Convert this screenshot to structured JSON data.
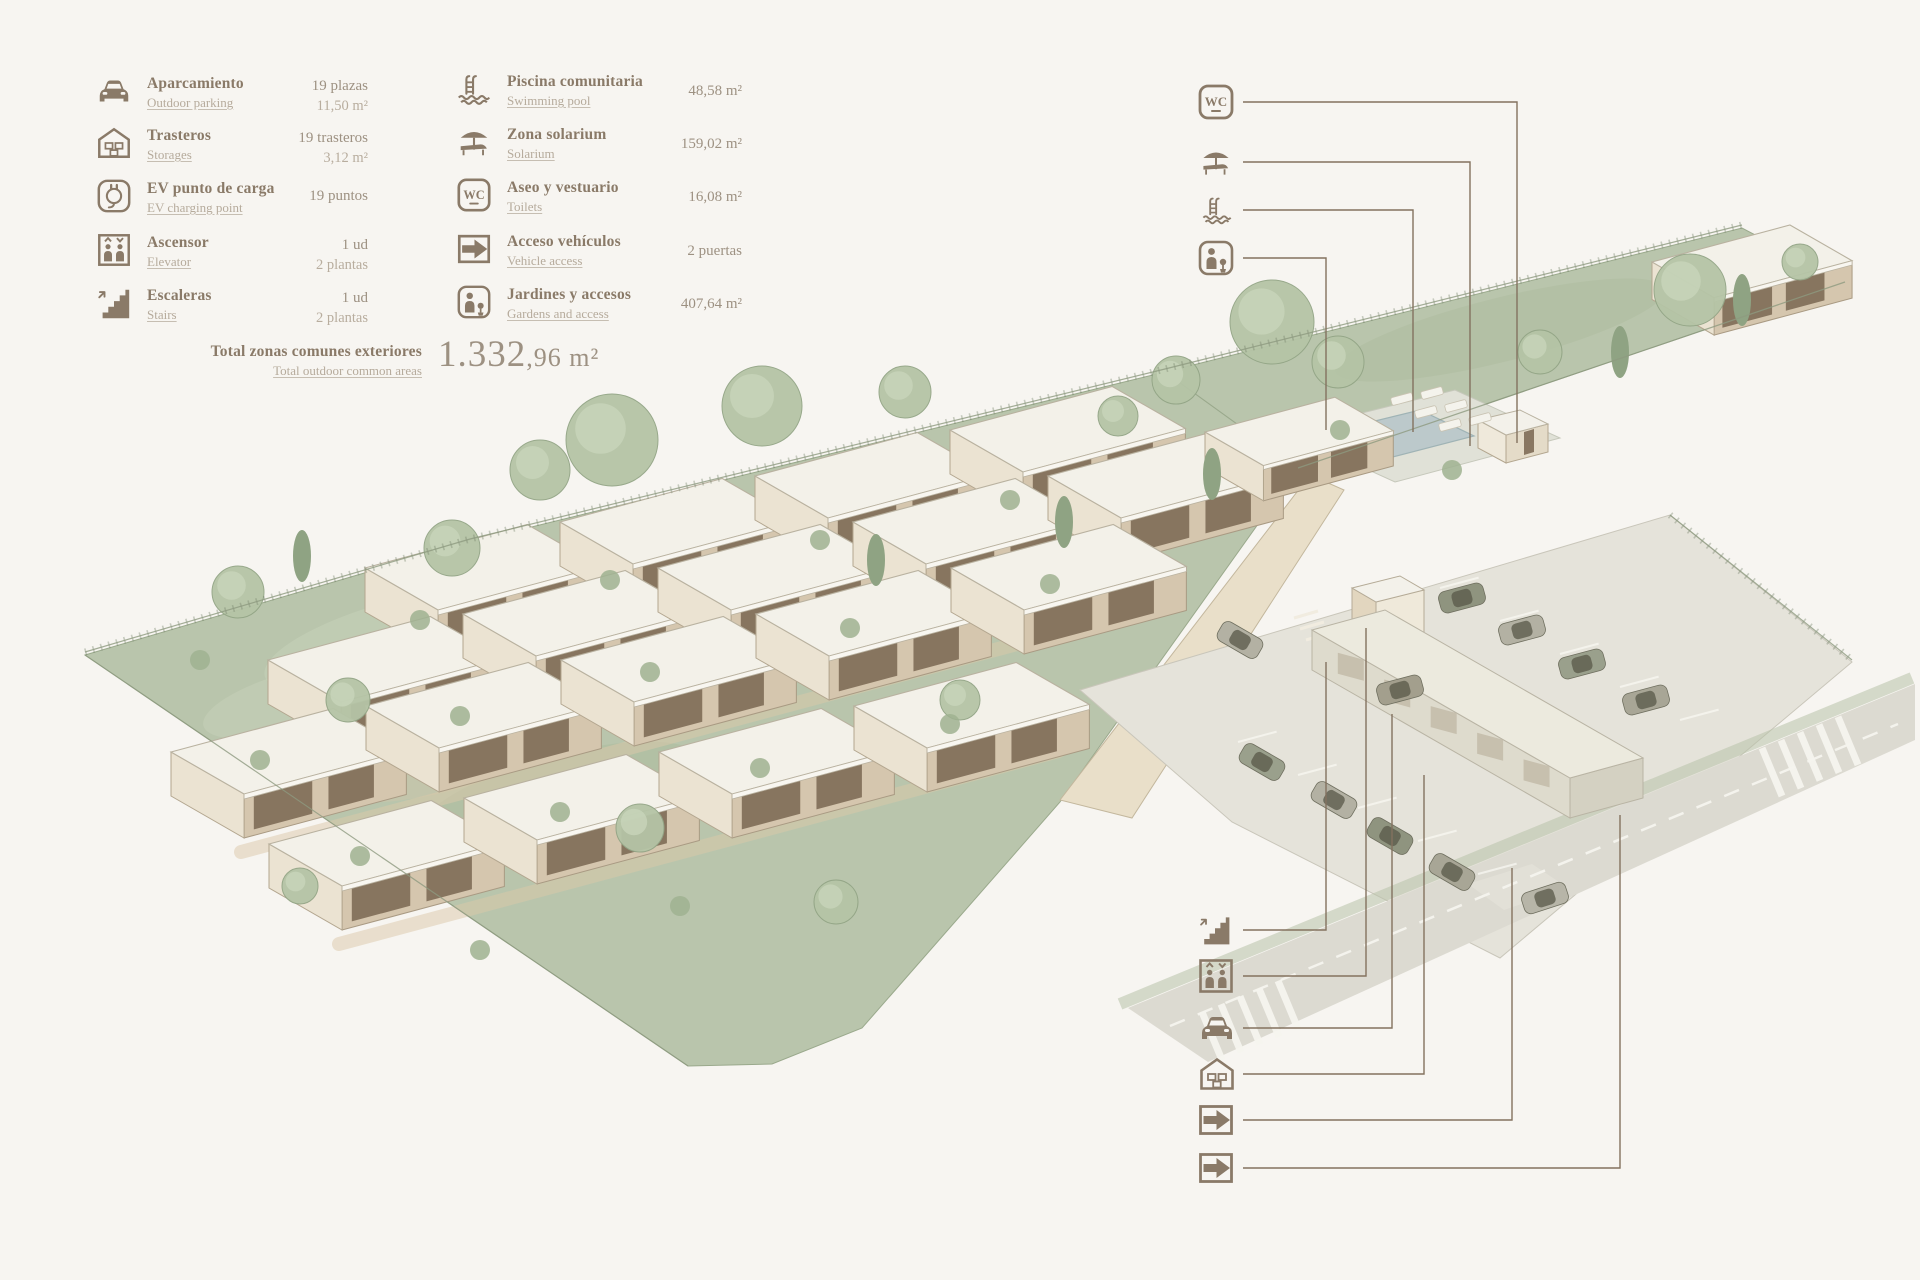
{
  "palette": {
    "background": "#f7f5f1",
    "accent_brown": "#8a7a68",
    "text_muted": "#b6ab9c",
    "plot_green": "#b9c5ac",
    "roof_white": "#f3f1e9",
    "wall_beige": "#d5c6ae",
    "paving_grey": "#e5e3da",
    "road_grey": "#dcdad1",
    "pool_blue": "#bcc9cb"
  },
  "icons": {
    "wc_label": "WC"
  },
  "legend": {
    "left": [
      {
        "icon": "car-icon",
        "label_es": "Aparcamiento",
        "label_en": "Outdoor parking",
        "value_lines": [
          "19 plazas",
          "11,50 m²"
        ]
      },
      {
        "icon": "storage-icon",
        "label_es": "Trasteros",
        "label_en": "Storages",
        "value_lines": [
          "19 trasteros",
          "3,12 m²"
        ]
      },
      {
        "icon": "ev-charging-icon",
        "label_es": "EV punto de carga",
        "label_en": "EV charging point",
        "value_lines": [
          "19 puntos"
        ]
      },
      {
        "icon": "elevator-icon",
        "label_es": "Ascensor",
        "label_en": "Elevator",
        "value_lines": [
          "1 ud",
          "2 plantas"
        ]
      },
      {
        "icon": "stairs-icon",
        "label_es": "Escaleras",
        "label_en": "Stairs",
        "value_lines": [
          "1 ud",
          "2 plantas"
        ]
      }
    ],
    "right": [
      {
        "icon": "pool-icon",
        "label_es": "Piscina comunitaria",
        "label_en": "Swimming pool",
        "value_lines": [
          "48,58 m²"
        ]
      },
      {
        "icon": "solarium-icon",
        "label_es": "Zona solarium",
        "label_en": "Solarium",
        "value_lines": [
          "159,02 m²"
        ]
      },
      {
        "icon": "wc-icon",
        "label_es": "Aseo y vestuario",
        "label_en": "Toilets",
        "value_lines": [
          "16,08 m²"
        ]
      },
      {
        "icon": "vehicle-access-icon",
        "label_es": "Acceso vehículos",
        "label_en": "Vehicle access",
        "value_lines": [
          "2 puertas"
        ]
      },
      {
        "icon": "gardens-icon",
        "label_es": "Jardines y accesos",
        "label_en": "Gardens and access",
        "value_lines": [
          "407,64 m²"
        ]
      }
    ],
    "total": {
      "label_es": "Total zonas comunes exteriores",
      "label_en": "Total outdoor common areas",
      "value": "1.332,96 m²",
      "value_int": "1.332",
      "value_dec": ",96 m²"
    }
  },
  "callouts": {
    "top_right": [
      "wc-icon",
      "solarium-icon",
      "pool-icon",
      "gardens-icon"
    ],
    "bottom_right": [
      "stairs-icon",
      "elevator-icon",
      "car-icon",
      "storage-icon",
      "vehicle-access-icon",
      "vehicle-access-icon"
    ]
  }
}
